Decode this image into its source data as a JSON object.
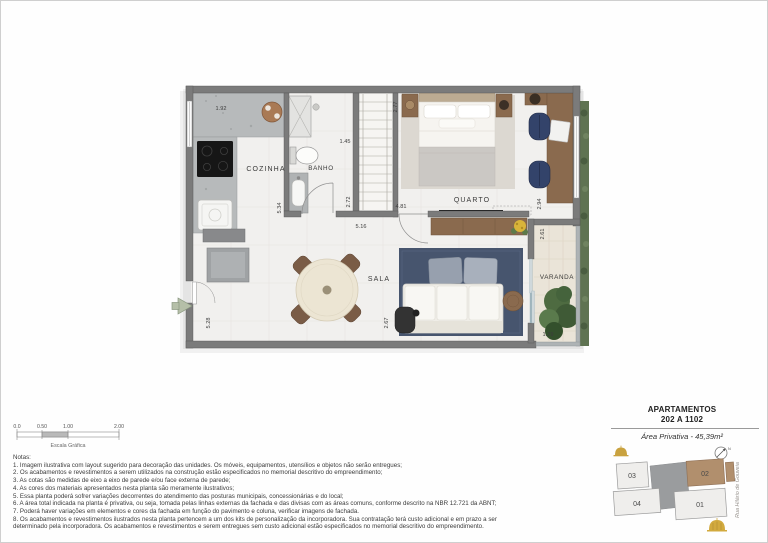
{
  "plan": {
    "room_labels": {
      "cozinha": "COZINHA",
      "banho": "BANHO",
      "quarto": "QUARTO",
      "sala": "SALA",
      "varanda": "VARANDA"
    },
    "dimensions": {
      "kitchen_top": "1.92",
      "bath_top": "1.45",
      "closet_side": "2.77",
      "kitchen_side": "5.34",
      "bath_side": "2.72",
      "bedroom_width": "4.81",
      "living_width": "5.16",
      "bedroom_side": "2.94",
      "balcony_side": "2.61",
      "living_side": "5.28",
      "sofa_side": "2.67",
      "balcony_width": "1.29"
    }
  },
  "scale_bar": {
    "ticks": [
      "0.0",
      "0.50",
      "1.00",
      "2.00"
    ],
    "label": "Escala Gráfica"
  },
  "notes": {
    "title": "Notas:",
    "items": [
      "1. Imagem ilustrativa com layout sugerido para decoração das unidades. Os móveis, equipamentos, utensílios e objetos não serão entregues;",
      "2. Os acabamentos e revestimentos a serem utilizados na construção estão especificados no memorial descritivo do empreendimento;",
      "3. As cotas são medidas de eixo a eixo de parede e/ou face externa de parede;",
      "4. As cores dos materiais apresentados nesta planta são meramente ilustrativos;",
      "5. Essa planta poderá sofrer variações decorrentes do atendimento das posturas municipais, concessionárias e do local;",
      "6. A área total indicada na planta é privativa, ou seja, tomada pelas linhas externas da fachada e das divisas com as áreas comuns, conforme descrito na NBR 12.721 da ABNT;",
      "7. Poderá haver variações em elementos e cores da fachada em função do pavimento e coluna, verificar imagens de fachada.",
      "8. Os acabamentos e revestimentos ilustrados nesta planta pertencem a um dos kits de personalização da incorporadora. Sua contratação terá custo adicional e em prazo a ser determinado pela incorporadora. Os acabamentos e revestimentos e serem entregues sem custo adicional estão especificados no memorial descritivo do empreendimento."
    ]
  },
  "info_panel": {
    "title_line1": "APARTAMENTOS",
    "title_line2": "202 A 1102",
    "area_text": "Área Privativa - 45,39m²",
    "street": "Rua Hilário de Gouveia",
    "compass": "N",
    "keyplan": {
      "u1": "01",
      "u2": "02",
      "u3": "03",
      "u4": "04"
    }
  },
  "colors": {
    "wall": "#7b7b7b",
    "rug_blue": "#47556e",
    "wood": "#8a6a4e",
    "highlight_unit": "#b18f6d",
    "gold": "#c9a23f"
  }
}
